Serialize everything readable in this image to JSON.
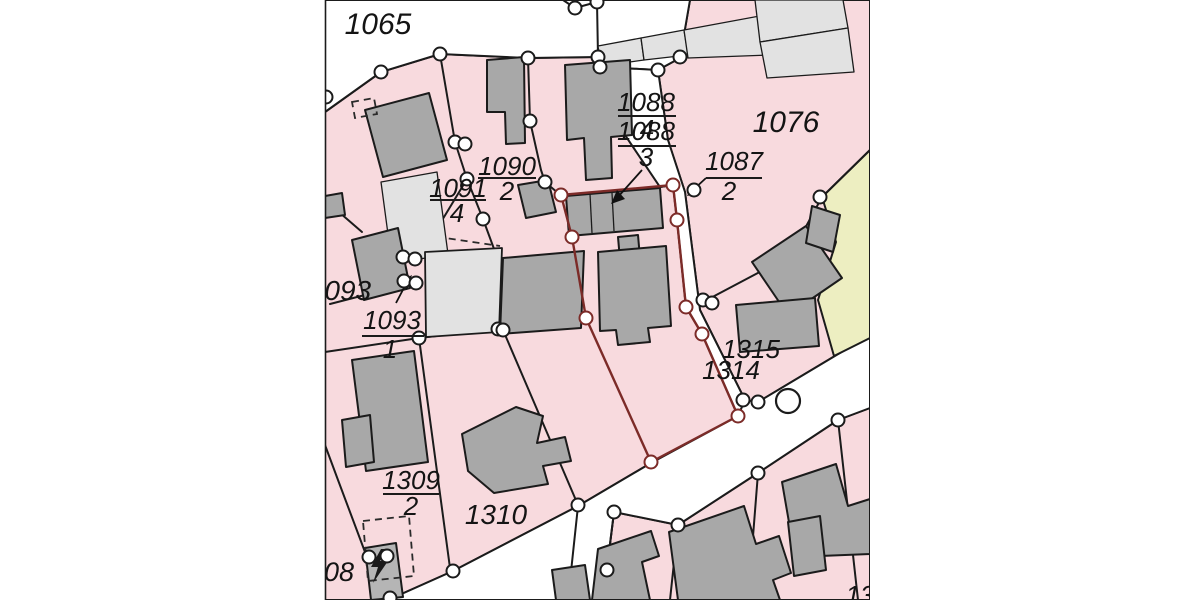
{
  "map": {
    "type": "cadastral-parcel-map",
    "colors": {
      "background": "#ffffff",
      "parcel_fill": "#f8dade",
      "road_fill": "#ffffff",
      "building_fill": "#a8a8a8",
      "light_building_fill": "#e2e2e2",
      "special_parcel_fill": "#edeec1",
      "boundary_line": "#1b1b1b",
      "selected_parcel_outline": "#7c2b28",
      "vertex_fill": "#ffffff"
    },
    "parcel_labels": {
      "p1065": "1065",
      "p1076": "1076",
      "p1093_full": "1093",
      "p1310": "1310",
      "p1315": "1315",
      "p1314": "1314",
      "p1308_partial": "1308",
      "p_corner_partial": "13"
    },
    "fraction_labels": {
      "f1090": {
        "numerator": "1090",
        "denominator": "2"
      },
      "f1091": {
        "numerator": "1091",
        "denominator": "4"
      },
      "f1088a": {
        "numerator": "1088",
        "denominator": "4"
      },
      "f1088b": {
        "numerator": "1088",
        "denominator": "3"
      },
      "f1087": {
        "numerator": "1087",
        "denominator": "2"
      },
      "f1093": {
        "numerator": "1093",
        "denominator": "1"
      },
      "f1309": {
        "numerator": "1309",
        "denominator": "2"
      }
    },
    "symbols": {
      "transformer": "lightning-bolt",
      "survey_point_large": "circle",
      "boundary_vertex": "small-circle"
    }
  }
}
